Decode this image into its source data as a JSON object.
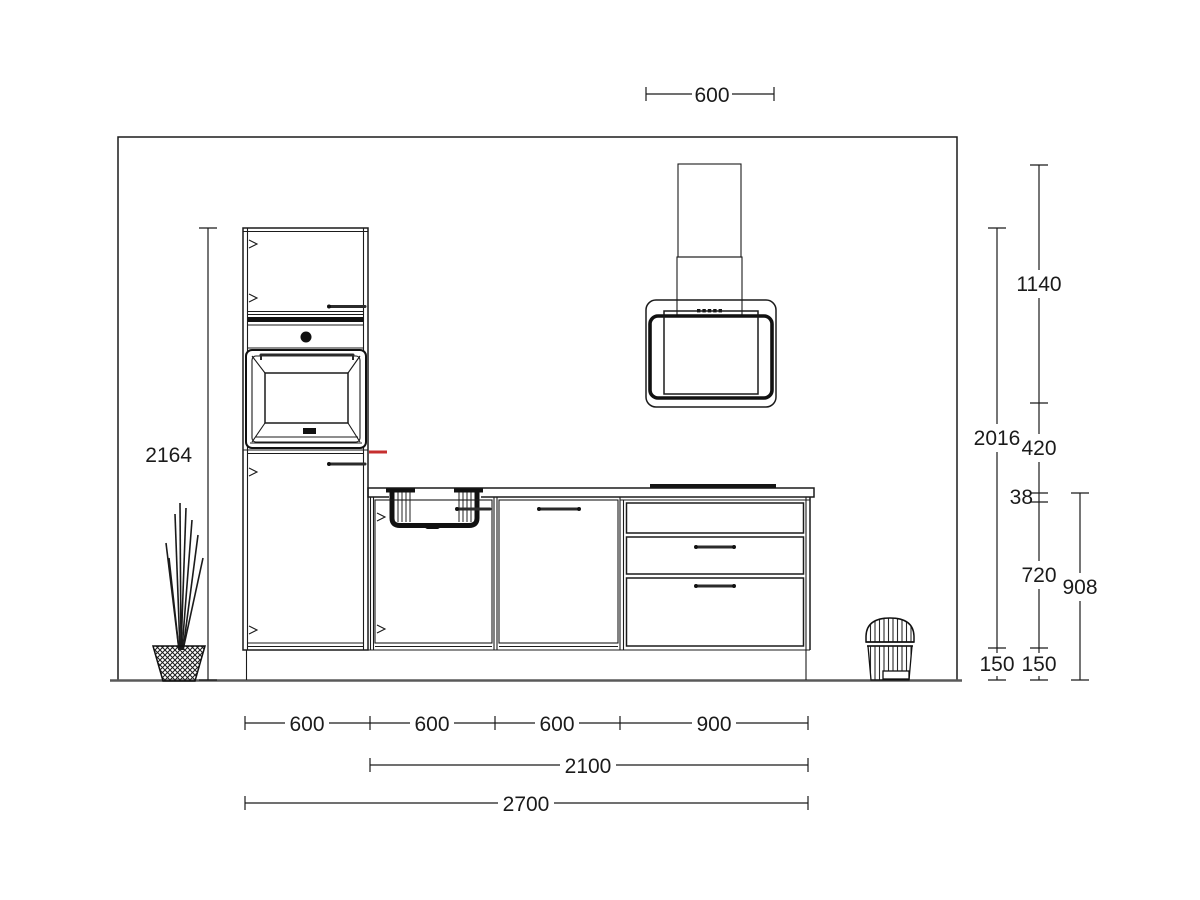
{
  "drawing": {
    "type": "kitchen-elevation-technical-drawing",
    "colors": {
      "line": "#1b1b1b",
      "floor": "#5a5a5a",
      "marker": "#c62f2f",
      "background": "#ffffff"
    },
    "symbols": [
      "tall-oven-unit",
      "sink-base-unit",
      "door-base-unit",
      "drawer-base-unit",
      "range-hood",
      "chimney-duct",
      "cooktop",
      "plant",
      "pedal-bin"
    ]
  },
  "dims": {
    "hood_width": "600",
    "total_height": "2164",
    "tall_unit_height": "2016",
    "chimney_height": "1140",
    "hood_clearance": "420",
    "worktop_thickness": "38",
    "carcass_height": "720",
    "plinth_height_a": "150",
    "plinth_height_b": "150",
    "worktop_height": "908",
    "unit_widths": [
      "600",
      "600",
      "600",
      "900"
    ],
    "run_width": "2100",
    "total_width": "2700"
  }
}
